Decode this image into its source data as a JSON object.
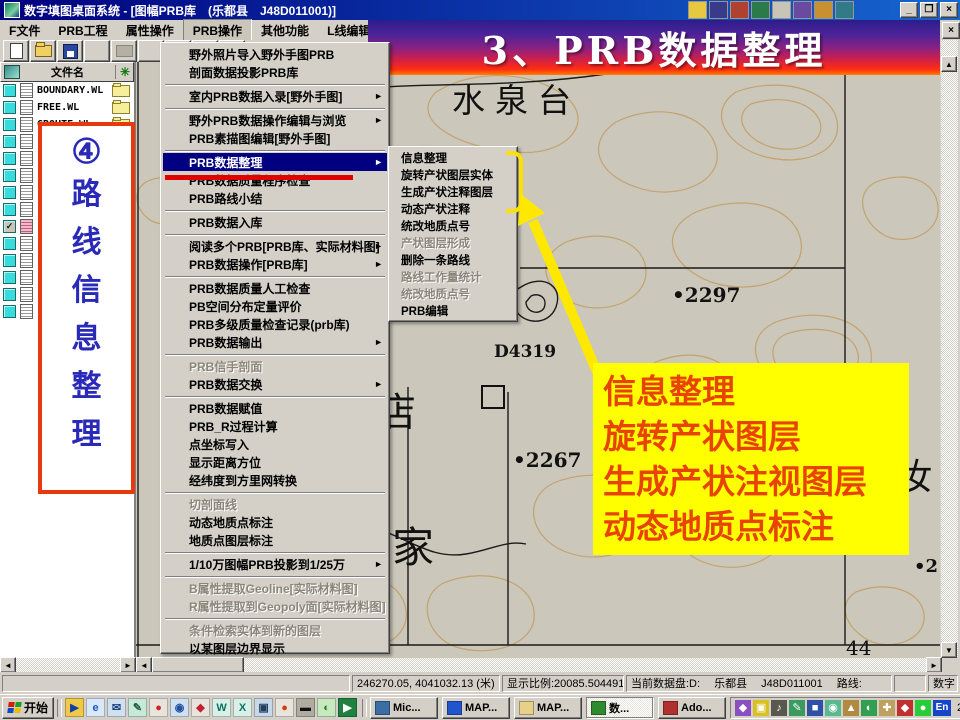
{
  "window": {
    "title": "数字填图桌面系统 - [图幅PRB库　(乐都县　J48D011001)]",
    "minimize": "_",
    "restore": "❐",
    "close": "×",
    "doc_close": "×"
  },
  "menu_bar": {
    "items": [
      {
        "label": "F文件"
      },
      {
        "label": "PRB工程"
      },
      {
        "label": "属性操作"
      },
      {
        "label": "PRB操作",
        "active": true
      },
      {
        "label": "其他功能"
      },
      {
        "label": "L线编辑"
      },
      {
        "label": "R区编辑"
      }
    ]
  },
  "toolbar": {
    "items": [
      {
        "name": "new-button",
        "cls": "tb-new"
      },
      {
        "name": "open-button",
        "cls": "tb-open"
      },
      {
        "name": "save-button",
        "cls": "tb-save"
      },
      {
        "separator": true
      },
      {
        "name": "print-button",
        "cls": "tb-print"
      },
      {
        "separator": true
      },
      {
        "name": "undo-button",
        "cls": "tb-undo",
        "glyph": "↶"
      },
      {
        "name": "help-button",
        "cls": "tb-help",
        "glyph": "?"
      },
      {
        "name": "context-help-button",
        "cls": "tb-ctx",
        "glyph": "▸?"
      }
    ]
  },
  "banner": {
    "text": "3、PRB数据整理"
  },
  "sidebar": {
    "header": "文件名",
    "header_right_icon": "✳",
    "files": [
      {
        "name": "BOUNDARY.WL",
        "folder": true
      },
      {
        "name": "FREE.WL",
        "folder": true
      },
      {
        "name": "GROUTE.WL",
        "folder": true
      },
      {
        "name": ""
      },
      {
        "name": ""
      },
      {
        "name": ""
      },
      {
        "name": ""
      },
      {
        "name": ""
      },
      {
        "name": "",
        "checked": true,
        "pink": true
      },
      {
        "name": ""
      },
      {
        "name": ""
      },
      {
        "name": ""
      },
      {
        "name": ""
      },
      {
        "name": ""
      }
    ],
    "callout": {
      "number": "④",
      "chars": [
        "路",
        "线",
        "信",
        "息",
        "整",
        "理"
      ]
    }
  },
  "dropdown_menu": {
    "items": [
      {
        "label": "野外照片导入野外手图PRB"
      },
      {
        "label": "剖面数据投影PRB库"
      },
      {
        "separator": true
      },
      {
        "label": "室内PRB数据入录[野外手图]",
        "arrow": true
      },
      {
        "separator": true
      },
      {
        "label": "野外PRB数据操作编辑与浏览",
        "arrow": true
      },
      {
        "label": "PRB素描图编辑[野外手图]"
      },
      {
        "separator": true
      },
      {
        "label": "PRB数据整理",
        "arrow": true,
        "highlighted": true
      },
      {
        "label": "PRB数据质量程序检查"
      },
      {
        "label": "PRB路线小结"
      },
      {
        "separator": true
      },
      {
        "label": "PRB数据入库"
      },
      {
        "separator": true
      },
      {
        "label": "阅读多个PRB[PRB库、实际材料图]",
        "arrow": true
      },
      {
        "label": "PRB数据操作[PRB库]",
        "arrow": true
      },
      {
        "separator": true
      },
      {
        "label": "PRB数据质量人工检查"
      },
      {
        "label": "PB空间分布定量评价"
      },
      {
        "label": "PRB多级质量检查记录(prb库)"
      },
      {
        "label": "PRB数据输出",
        "arrow": true
      },
      {
        "separator": true
      },
      {
        "label": "PRB信手剖面",
        "disabled": true
      },
      {
        "label": "PRB数据交换",
        "arrow": true
      },
      {
        "separator": true
      },
      {
        "label": "PRB数据赋值"
      },
      {
        "label": "PRB_R过程计算"
      },
      {
        "label": "点坐标写入"
      },
      {
        "label": "显示距离方位"
      },
      {
        "label": "经纬度到方里网转换"
      },
      {
        "separator": true
      },
      {
        "label": "切剖面线",
        "disabled": true
      },
      {
        "label": "动态地质点标注"
      },
      {
        "label": "地质点图层标注"
      },
      {
        "separator": true
      },
      {
        "label": "1/10万图幅PRB投影到1/25万",
        "arrow": true
      },
      {
        "separator": true
      },
      {
        "label": "B属性提取Geoline[实际材料图]",
        "disabled": true
      },
      {
        "label": "R属性提取到Geopoly面[实际材料图]",
        "disabled": true
      },
      {
        "separator": true
      },
      {
        "label": "条件检索实体到新的图层",
        "disabled": true
      },
      {
        "label": "以某图层边界显示"
      }
    ],
    "arrow_glyph": "►"
  },
  "submenu": {
    "items": [
      {
        "label": "信息整理"
      },
      {
        "label": "旋转产状图层实体"
      },
      {
        "label": "生成产状注释图层"
      },
      {
        "label": "动态产状注释"
      },
      {
        "label": "统改地质点号"
      },
      {
        "label": "产状图层形成",
        "disabled": true
      },
      {
        "label": "删除一条路线"
      },
      {
        "label": "路线工作量统计",
        "disabled": true
      },
      {
        "label": "统改地质点号",
        "disabled": true
      },
      {
        "label": "PRB编辑"
      }
    ]
  },
  "map": {
    "labels": {
      "shuiquantai": "水泉台",
      "elev1": "•2297",
      "point_id": "D4319",
      "elev2": "•2267",
      "dian": "店",
      "jia": "家",
      "ru": "汝",
      "elev3": "•2"
    },
    "page_number": "44"
  },
  "annotation": {
    "lines": [
      {
        "text": "信息整理"
      },
      {
        "text": "旋转产状图层"
      },
      {
        "text": "生成产状注视图层"
      },
      {
        "text": "动态地质点标注"
      }
    ],
    "highlight_color": "#ffff00",
    "text_color": "#e84300"
  },
  "status_bar": {
    "coords": "246270.05, 4041032.13 (米)",
    "scale": "显示比例:20085.504491",
    "disk": "当前数据盘:D:　 乐都县 　J48D011001 　路线:",
    "right": "数字"
  },
  "taskbar": {
    "start_label": "开始",
    "quick_launch": [
      {
        "name": "media-player-icon",
        "glyph": "▶",
        "color": "#f0c84a",
        "fg": "#1040a0"
      },
      {
        "name": "internet-explorer-icon",
        "glyph": "e",
        "color": "#d8e8f8",
        "fg": "#1a5ac0"
      },
      {
        "name": "outlook-icon",
        "glyph": "✉",
        "color": "#cfe0f0",
        "fg": "#204080"
      },
      {
        "name": "wordpad-icon",
        "glyph": "✎",
        "color": "#c8e8d8",
        "fg": "#206040"
      },
      {
        "name": "balloon-icon",
        "glyph": "●",
        "color": "#e8e4dc",
        "fg": "#d02020"
      },
      {
        "name": "search-icon",
        "glyph": "◉",
        "color": "#d0e0f0",
        "fg": "#2050a0"
      },
      {
        "name": "flag-icon",
        "glyph": "◆",
        "color": "#e8e4dc",
        "fg": "#c02030"
      },
      {
        "name": "word-icon",
        "glyph": "W",
        "color": "#d8f0e8",
        "fg": "#107060"
      },
      {
        "name": "excel-icon",
        "glyph": "X",
        "color": "#d8f0e8",
        "fg": "#107060"
      },
      {
        "name": "display-icon",
        "glyph": "▣",
        "color": "#c8d8e8",
        "fg": "#204060"
      },
      {
        "name": "balloon2-icon",
        "glyph": "●",
        "color": "#e8e4dc",
        "fg": "#d04010"
      },
      {
        "name": "chip-icon",
        "glyph": "▬",
        "color": "#b0aca0",
        "fg": "#101010"
      },
      {
        "name": "cd-player-icon",
        "glyph": "◐",
        "color": "#c8e8c0",
        "fg": "#208020"
      },
      {
        "name": "tv-icon",
        "glyph": "▶",
        "color": "#208040",
        "fg": "#ffffff"
      }
    ],
    "task_buttons": [
      {
        "label": "Mic...",
        "color": "#3a6ea5"
      },
      {
        "label": "MAP...",
        "color": "#2255cc"
      },
      {
        "label": "MAP...",
        "color": "#e8d088"
      },
      {
        "label": "数...",
        "color": "#2d8a2d",
        "active": true
      },
      {
        "label": "Ado...",
        "color": "#b03030"
      }
    ],
    "tray_icons": [
      {
        "name": "tray-app1-icon",
        "glyph": "◆",
        "color": "#8a4fc0"
      },
      {
        "name": "tray-app2-icon",
        "glyph": "▣",
        "color": "#d8c020"
      },
      {
        "name": "tray-app3-icon",
        "glyph": "♪",
        "color": "#585850"
      },
      {
        "name": "tray-app4-icon",
        "glyph": "✎",
        "color": "#3a9a60"
      },
      {
        "name": "tray-app5-icon",
        "glyph": "■",
        "color": "#3050a8"
      },
      {
        "name": "tray-search-icon",
        "glyph": "◉",
        "color": "#58b890"
      },
      {
        "name": "tray-app6-icon",
        "glyph": "▲",
        "color": "#b08a40"
      },
      {
        "name": "tray-disc-icon",
        "glyph": "◐",
        "color": "#30a050"
      },
      {
        "name": "tray-scroll-icon",
        "glyph": "✚",
        "color": "#c0a060"
      },
      {
        "name": "tray-shield-icon",
        "glyph": "◆",
        "color": "#c03030"
      },
      {
        "name": "tray-status-icon",
        "glyph": "●",
        "color": "#28cc38"
      }
    ],
    "lang": "En",
    "clock": "22:58"
  }
}
